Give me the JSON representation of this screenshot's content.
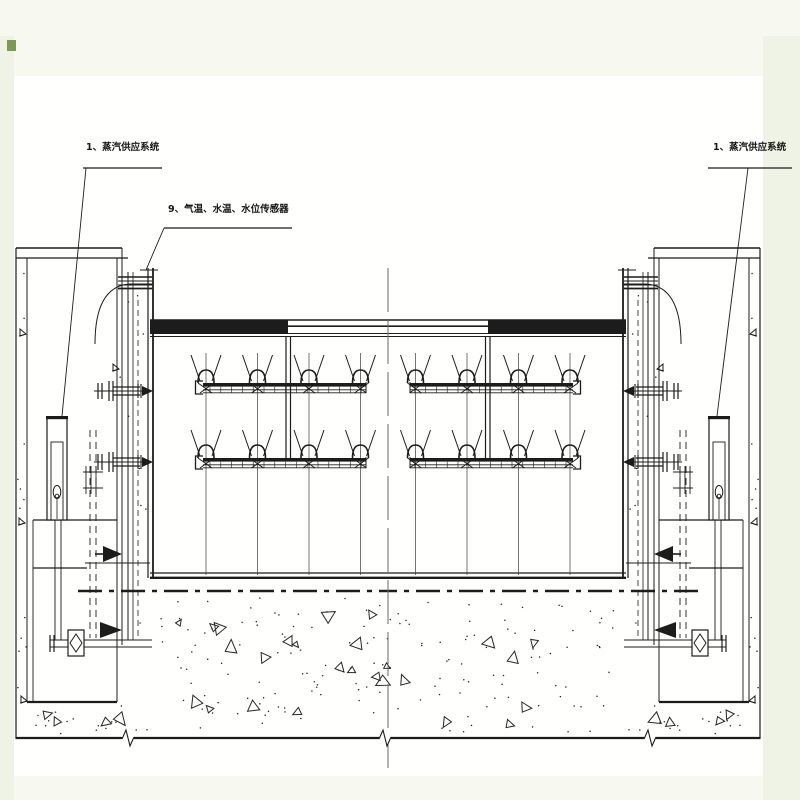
{
  "labels": {
    "steam_supply_left": "1、蒸汽供应系统",
    "sensors": "9、气温、水温、水位传感器",
    "steam_supply_right": "1、蒸汽供应系统"
  },
  "colors": {
    "background": "#f7f9f1",
    "margin_tint": "#eef3e5",
    "paper": "#fffffe",
    "line": "#1c1c1c",
    "centerline": "#6a6a6a",
    "texture": "#262626",
    "green_mark": "#7c9a55"
  },
  "drawing": {
    "spray_rows": 2,
    "pipes_per_row": 2,
    "nozzles_per_pipe": 4
  }
}
